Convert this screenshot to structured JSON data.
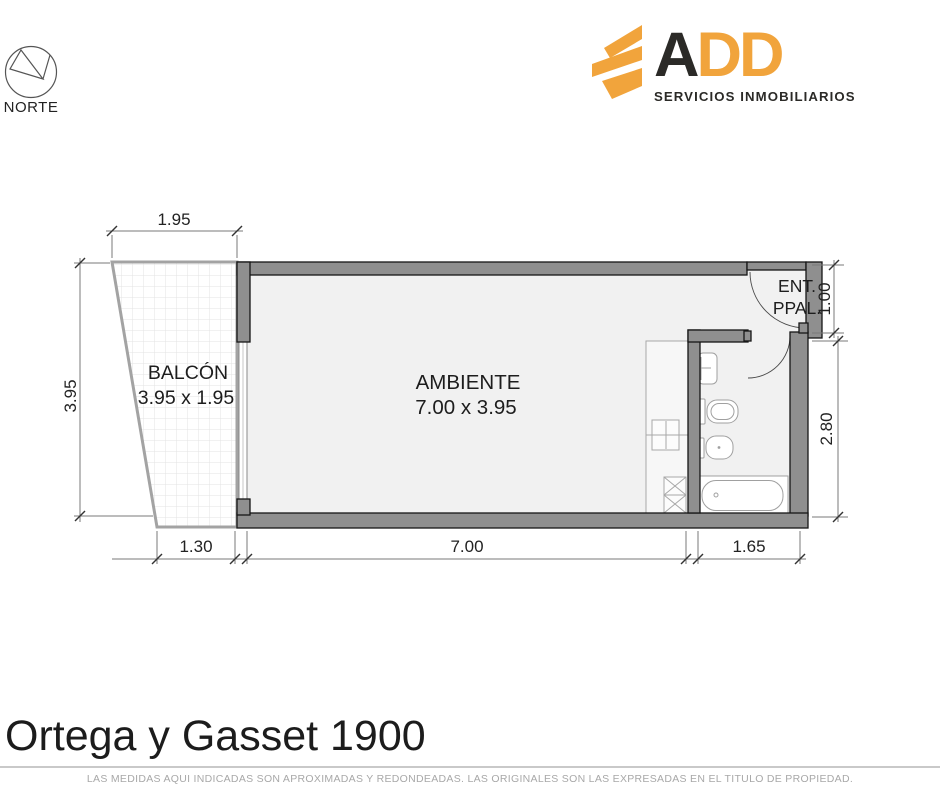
{
  "header": {
    "north": {
      "label": "NORTE"
    },
    "brand": {
      "word_dark": "A",
      "word_accent": "DD",
      "tagline": "SERVICIOS INMOBILIARIOS",
      "accent_color": "#F1A43C",
      "text_color": "#2B2A27"
    }
  },
  "plan": {
    "balcony": {
      "name": "BALCÓN",
      "size": "3.95 x 1.95"
    },
    "room": {
      "name": "AMBIENTE",
      "size": "7.00 x 3.95"
    },
    "entrance": {
      "line1": "ENT.",
      "line2": "PPAL."
    },
    "dims": {
      "top": "1.95",
      "left": "3.95",
      "bottom_left": "1.30",
      "bottom_center": "7.00",
      "bottom_right": "1.65",
      "right_top": "1.00",
      "right_center": "2.80"
    },
    "colors": {
      "wall": "#8F8F8F",
      "floor": "#F1F1F1"
    }
  },
  "footer": {
    "title": "Ortega y Gasset 1900",
    "disclaimer": "LAS MEDIDAS AQUI INDICADAS SON APROXIMADAS Y REDONDEADAS. LAS ORIGINALES SON LAS EXPRESADAS EN EL TITULO DE PROPIEDAD."
  }
}
